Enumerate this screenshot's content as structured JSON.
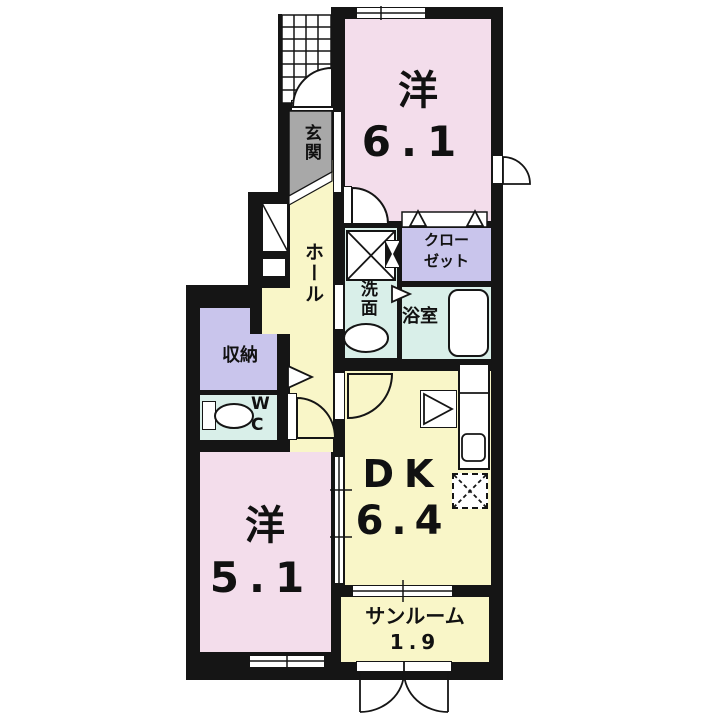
{
  "floorplan": {
    "rooms": {
      "western1": {
        "name": "洋",
        "size": "6.1"
      },
      "western2": {
        "name": "洋",
        "size": "5.1"
      },
      "dk": {
        "name": "DK",
        "size": "6.4"
      },
      "sunroom": {
        "name": "サンルーム",
        "size": "1.9"
      },
      "entrance": {
        "name": "玄関"
      },
      "hall": {
        "name": "ホール"
      },
      "washroom": {
        "name": "洗面"
      },
      "closet": {
        "name": "クロー\nゼット"
      },
      "bathroom": {
        "name": "浴室"
      },
      "storage": {
        "name": "収納"
      },
      "wc": {
        "name": "W\nC"
      }
    },
    "colors": {
      "wall": "#151515",
      "room_pink": "#f3ddeb",
      "room_yellow": "#f9f6c8",
      "room_purple": "#c9c5ec",
      "room_cyan": "#d9efe9",
      "entrance_gray": "#a8a8a8",
      "fixture_white": "#ffffff"
    }
  }
}
